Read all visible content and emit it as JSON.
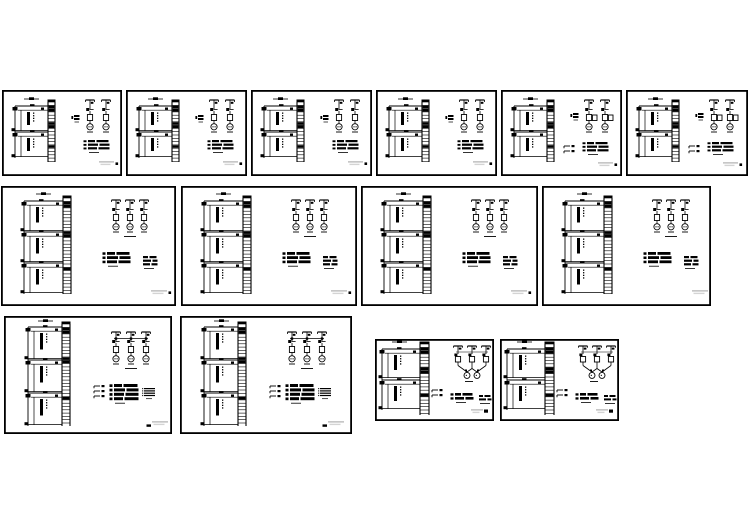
{
  "app": {
    "description": "collage of CAD electrical riser / distribution system drawing sheets on a white background",
    "paper_color": "#ffffff",
    "ink_color": "#000000",
    "faint_text_color": "#c7c7c7",
    "faint_text_color2": "#d4d4d4"
  },
  "canvas": {
    "width": 749,
    "height": 530
  },
  "sheets": [
    {
      "id": "sheet-01",
      "x": 2,
      "y": 90,
      "w": 120,
      "h": 86,
      "variant": "small"
    },
    {
      "id": "sheet-02",
      "x": 126,
      "y": 90,
      "w": 121,
      "h": 86,
      "variant": "small"
    },
    {
      "id": "sheet-03",
      "x": 251,
      "y": 90,
      "w": 121,
      "h": 86,
      "variant": "small"
    },
    {
      "id": "sheet-04",
      "x": 376,
      "y": 90,
      "w": 121,
      "h": 86,
      "variant": "small"
    },
    {
      "id": "sheet-05",
      "x": 501,
      "y": 90,
      "w": 121,
      "h": 86,
      "variant": "small-brackets"
    },
    {
      "id": "sheet-06",
      "x": 626,
      "y": 90,
      "w": 122,
      "h": 86,
      "variant": "small-brackets"
    },
    {
      "id": "sheet-07",
      "x": 1,
      "y": 186,
      "w": 175,
      "h": 120,
      "variant": "medium"
    },
    {
      "id": "sheet-08",
      "x": 181,
      "y": 186,
      "w": 176,
      "h": 120,
      "variant": "medium"
    },
    {
      "id": "sheet-09",
      "x": 361,
      "y": 186,
      "w": 177,
      "h": 120,
      "variant": "medium"
    },
    {
      "id": "sheet-10",
      "x": 542,
      "y": 186,
      "w": 169,
      "h": 120,
      "variant": "medium"
    },
    {
      "id": "sheet-11",
      "x": 4,
      "y": 316,
      "w": 168,
      "h": 118,
      "variant": "large"
    },
    {
      "id": "sheet-12",
      "x": 180,
      "y": 316,
      "w": 172,
      "h": 118,
      "variant": "large"
    },
    {
      "id": "sheet-13",
      "x": 375,
      "y": 339,
      "w": 119,
      "h": 82,
      "variant": "converge"
    },
    {
      "id": "sheet-14",
      "x": 500,
      "y": 339,
      "w": 119,
      "h": 82,
      "variant": "converge"
    }
  ]
}
